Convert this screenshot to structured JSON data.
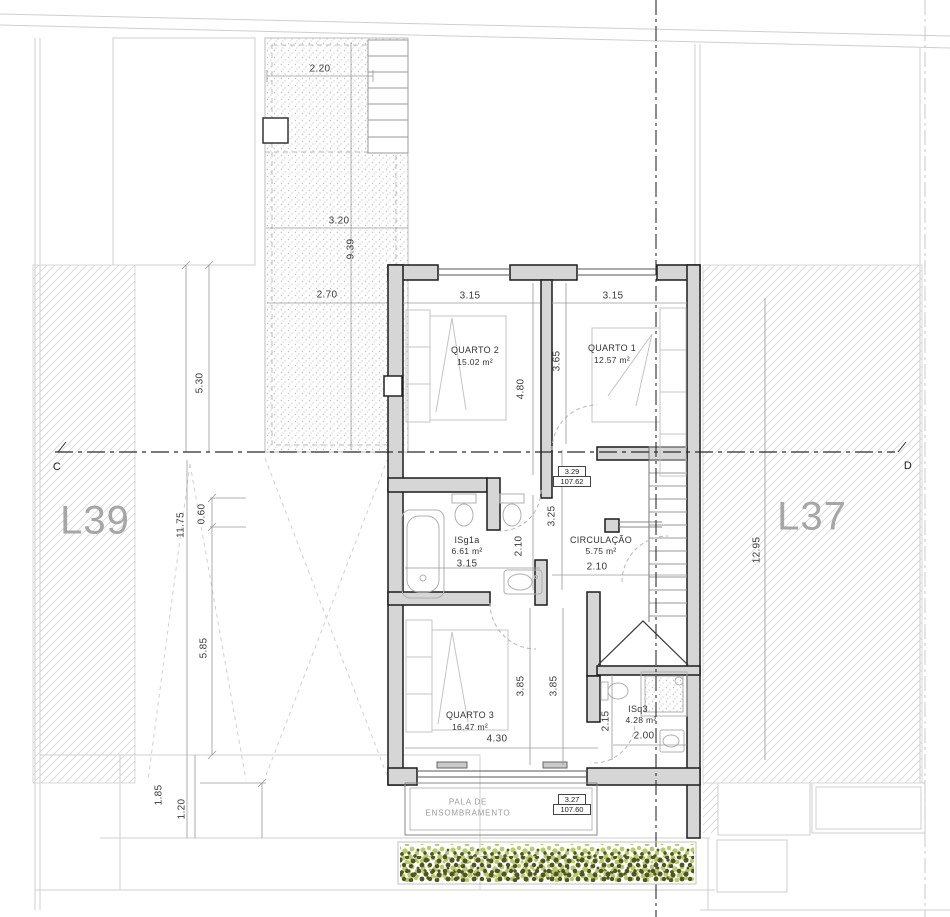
{
  "plots": {
    "left_label": "L39",
    "right_label": "L37"
  },
  "section_markers": {
    "left": "C",
    "right": "D"
  },
  "rooms": {
    "quarto2": {
      "name": "QUARTO 2",
      "area": "15.02 m²",
      "width": "3.15",
      "height": "4.80"
    },
    "quarto1": {
      "name": "QUARTO 1",
      "area": "12.57 m²",
      "width": "3.15",
      "height": "3.65"
    },
    "isg1a": {
      "name": "ISg1a",
      "area": "6.61 m²",
      "width": "3.15",
      "height": "2.10"
    },
    "circulacao": {
      "name": "CIRCULAÇÃO",
      "area": "5.75 m²",
      "width": "2.10",
      "height": "3.25"
    },
    "quarto3": {
      "name": "QUARTO 3",
      "area": "16.47 m²",
      "width": "4.30",
      "height_a": "3.85",
      "height_b": "3.85"
    },
    "isq3": {
      "name": "ISq3",
      "area": "4.28 m²",
      "width": "2.00",
      "height": "2.15"
    }
  },
  "levels": {
    "upper": {
      "value": "3.29",
      "elevation": "107.62"
    },
    "lower": {
      "value": "3.27",
      "elevation": "107.60"
    }
  },
  "annotations": {
    "pala_line1": "PALA DE",
    "pala_line2": "ENSOMBRAMENTO"
  },
  "site_dimensions": {
    "patio_top": "2.20",
    "patio_mid": "3.20",
    "patio_height": "9.39",
    "patio_low": "2.70",
    "left_a": "5.30",
    "left_b": "11.75",
    "left_c": "0.60",
    "left_d": "5.85",
    "left_e": "1.85",
    "left_f": "1.20",
    "right_a": "12.95"
  },
  "colors": {
    "vegetation_light": "#b9cc6d",
    "vegetation_dark": "#4f5420",
    "wall_fill": "#d6d6d6",
    "hatch_line": "#dadada",
    "plot_label": "#a6a6a6"
  }
}
